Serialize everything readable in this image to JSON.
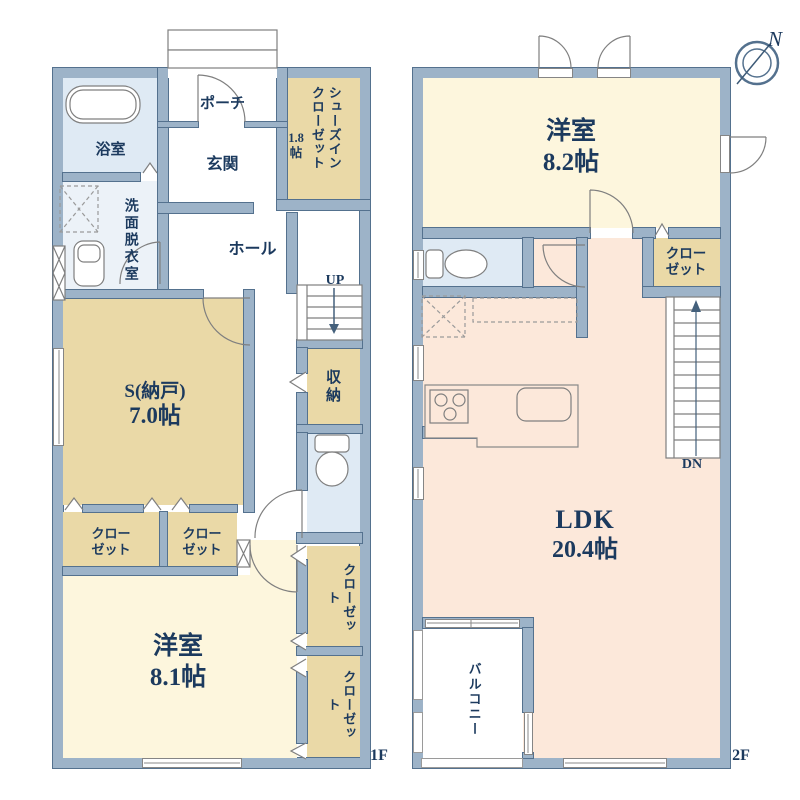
{
  "title": "floor-plan",
  "compass": {
    "north": "N"
  },
  "colors": {
    "wall_fill": "#9db3c8",
    "wall_line": "#54718e",
    "room_tan": "#ead9a7",
    "room_yellow": "#fdf6dd",
    "room_pink": "#fce8da",
    "room_blue": "#dfeaf4",
    "room_blue_light": "#ecf2f8",
    "text_navy": "#1c3a5e",
    "fixture_line": "#7f7f7f"
  },
  "floor1": {
    "label": "1F",
    "porch": "ポーチ",
    "bathroom": "浴室",
    "washroom": "洗面脱衣室",
    "entrance": "玄関",
    "shoes_closet": "シューズインクローゼット",
    "shoes_closet_area": "1.8帖",
    "hall": "ホール",
    "up": "UP",
    "storage_room": "S(納戸)",
    "storage_room_area": "7.0帖",
    "closet": "クローゼット",
    "storage": "収納",
    "bedroom": "洋室",
    "bedroom_area": "8.1帖"
  },
  "floor2": {
    "label": "2F",
    "bedroom": "洋室",
    "bedroom_area": "8.2帖",
    "closet": "クローゼット",
    "ldk": "LDK",
    "ldk_area": "20.4帖",
    "down": "DN",
    "balcony": "バルコニー"
  }
}
